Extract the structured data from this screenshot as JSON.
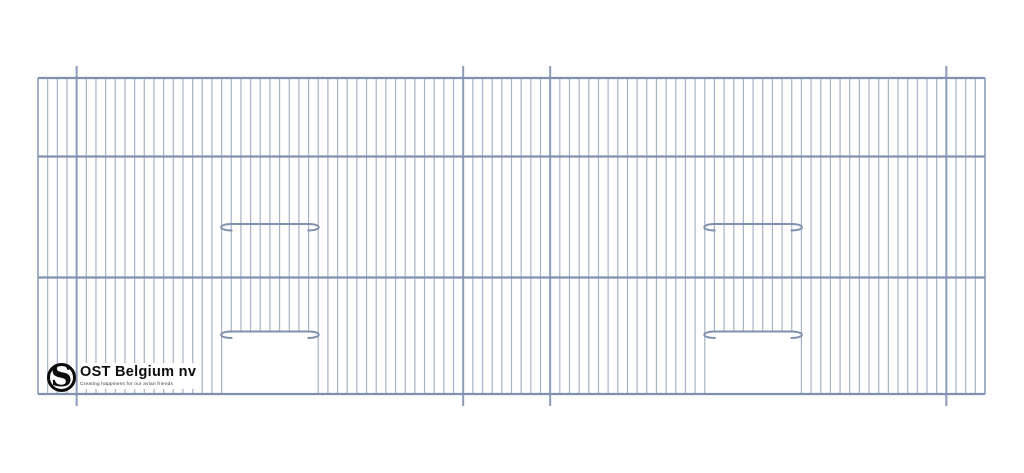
{
  "logo": {
    "company": "OST Belgium nv",
    "tagline": "Creating happiness for our avian friends",
    "mark_letter": "S"
  },
  "drawing": {
    "title": "wire cage front panel technical drawing",
    "colors": {
      "wire": "#a7b3c8",
      "rail": "#8091af",
      "dark_wire": "#8b9cba",
      "door_bar": "#8091af"
    },
    "frame": {
      "left": 38,
      "right": 985,
      "top": 78,
      "bottom": 394
    },
    "rails_y": [
      78,
      156.5,
      277.5,
      394
    ],
    "wire_count": 99,
    "wire_width": 1.2,
    "rail_width": 2.2,
    "stub_wire_indices": [
      4,
      44,
      53,
      94
    ],
    "stub_overhang": 12,
    "stub_width": 2,
    "doors": [
      {
        "left_wire": 19,
        "right_wire": 29,
        "skip_from": 20,
        "skip_to": 28,
        "top_bar_y": 224,
        "bottom_bar_y": 331.5
      },
      {
        "left_wire": 69,
        "right_wire": 79,
        "skip_from": 70,
        "skip_to": 78,
        "top_bar_y": 224,
        "bottom_bar_y": 331.5
      }
    ],
    "bar_width": 2,
    "hook_drop": 6.5,
    "hook_reach": 10
  }
}
